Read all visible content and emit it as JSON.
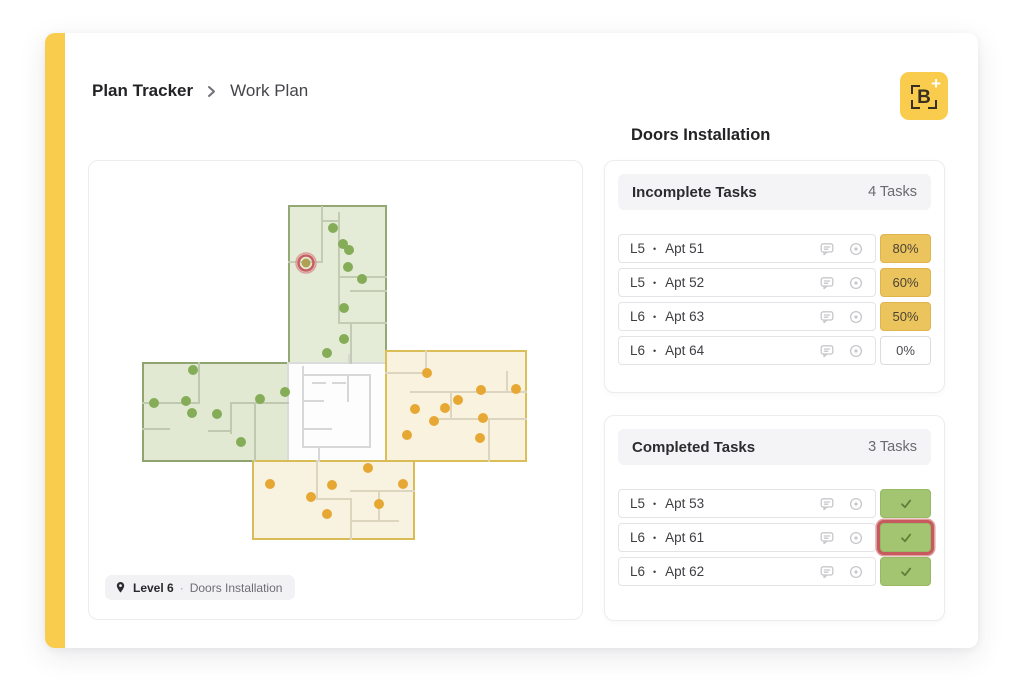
{
  "breadcrumb": {
    "section": "Plan Tracker",
    "page": "Work Plan"
  },
  "logo": {
    "letter": "B",
    "plus": "+"
  },
  "floorplan_card": {
    "badge": {
      "level": "Level 6",
      "separator": "·",
      "activity": "Doors Installation"
    },
    "regions": [
      {
        "name": "wing-top",
        "x": 200,
        "y": 45,
        "w": 97,
        "h": 157,
        "fill": "#E4EBD6",
        "stroke": "#93A873"
      },
      {
        "name": "wing-left",
        "x": 54,
        "y": 202,
        "w": 145,
        "h": 98,
        "fill": "#E2E9D3",
        "stroke": "#8FA46F"
      },
      {
        "name": "center-core",
        "x": 199,
        "y": 202,
        "w": 98,
        "h": 98,
        "fill": "#FDFDFD",
        "stroke": "#DBDBDB"
      },
      {
        "name": "wing-right",
        "x": 297,
        "y": 190,
        "w": 140,
        "h": 110,
        "fill": "#F9F2DF",
        "stroke": "#DCBE57"
      },
      {
        "name": "wing-bottom",
        "x": 164,
        "y": 300,
        "w": 161,
        "h": 78,
        "fill": "#F8F2E0",
        "stroke": "#D9BC55"
      }
    ],
    "markers": {
      "green": [
        [
          244,
          67
        ],
        [
          254,
          83
        ],
        [
          260,
          89
        ],
        [
          259,
          106
        ],
        [
          273,
          118
        ],
        [
          255,
          147
        ],
        [
          255,
          178
        ],
        [
          238,
          192
        ],
        [
          104,
          209
        ],
        [
          65,
          242
        ],
        [
          97,
          240
        ],
        [
          103,
          252
        ],
        [
          128,
          253
        ],
        [
          171,
          238
        ],
        [
          196,
          231
        ],
        [
          152,
          281
        ]
      ],
      "orange": [
        [
          338,
          212
        ],
        [
          392,
          229
        ],
        [
          427,
          228
        ],
        [
          369,
          239
        ],
        [
          326,
          248
        ],
        [
          356,
          247
        ],
        [
          345,
          260
        ],
        [
          394,
          257
        ],
        [
          318,
          274
        ],
        [
          391,
          277
        ],
        [
          279,
          307
        ],
        [
          181,
          323
        ],
        [
          243,
          324
        ],
        [
          314,
          323
        ],
        [
          222,
          336
        ],
        [
          290,
          343
        ],
        [
          238,
          353
        ]
      ],
      "selected": [
        217,
        102
      ]
    },
    "marker_colors": {
      "green": "#85AC57",
      "orange": "#E7A833",
      "selected_fill": "#AFA054",
      "selected_ring": "#C85F60",
      "selected_outer": "#DCA09C"
    }
  },
  "panel": {
    "title": "Doors Installation",
    "incomplete": {
      "title": "Incomplete Tasks",
      "count": "4 Tasks",
      "rows": [
        {
          "level": "L5",
          "separator": "•",
          "apt": "Apt 51",
          "progress": "80%",
          "style": "amber",
          "highlighted": false
        },
        {
          "level": "L5",
          "separator": "•",
          "apt": "Apt 52",
          "progress": "60%",
          "style": "amber",
          "highlighted": false
        },
        {
          "level": "L6",
          "separator": "•",
          "apt": "Apt 63",
          "progress": "50%",
          "style": "amber",
          "highlighted": false
        },
        {
          "level": "L6",
          "separator": "•",
          "apt": "Apt 64",
          "progress": "0%",
          "style": "plain",
          "highlighted": false
        }
      ]
    },
    "completed": {
      "title": "Completed Tasks",
      "count": "3 Tasks",
      "rows": [
        {
          "level": "L5",
          "separator": "•",
          "apt": "Apt 53",
          "progress": "",
          "style": "check",
          "highlighted": false
        },
        {
          "level": "L6",
          "separator": "•",
          "apt": "Apt 61",
          "progress": "",
          "style": "check",
          "highlighted": true
        },
        {
          "level": "L6",
          "separator": "•",
          "apt": "Apt 62",
          "progress": "",
          "style": "check",
          "highlighted": false
        }
      ]
    }
  },
  "colors": {
    "accent": "#F9CC4D",
    "amber_badge": "#ECC45E",
    "green_badge": "#A3C572",
    "highlight_red": "#C75A5E"
  }
}
